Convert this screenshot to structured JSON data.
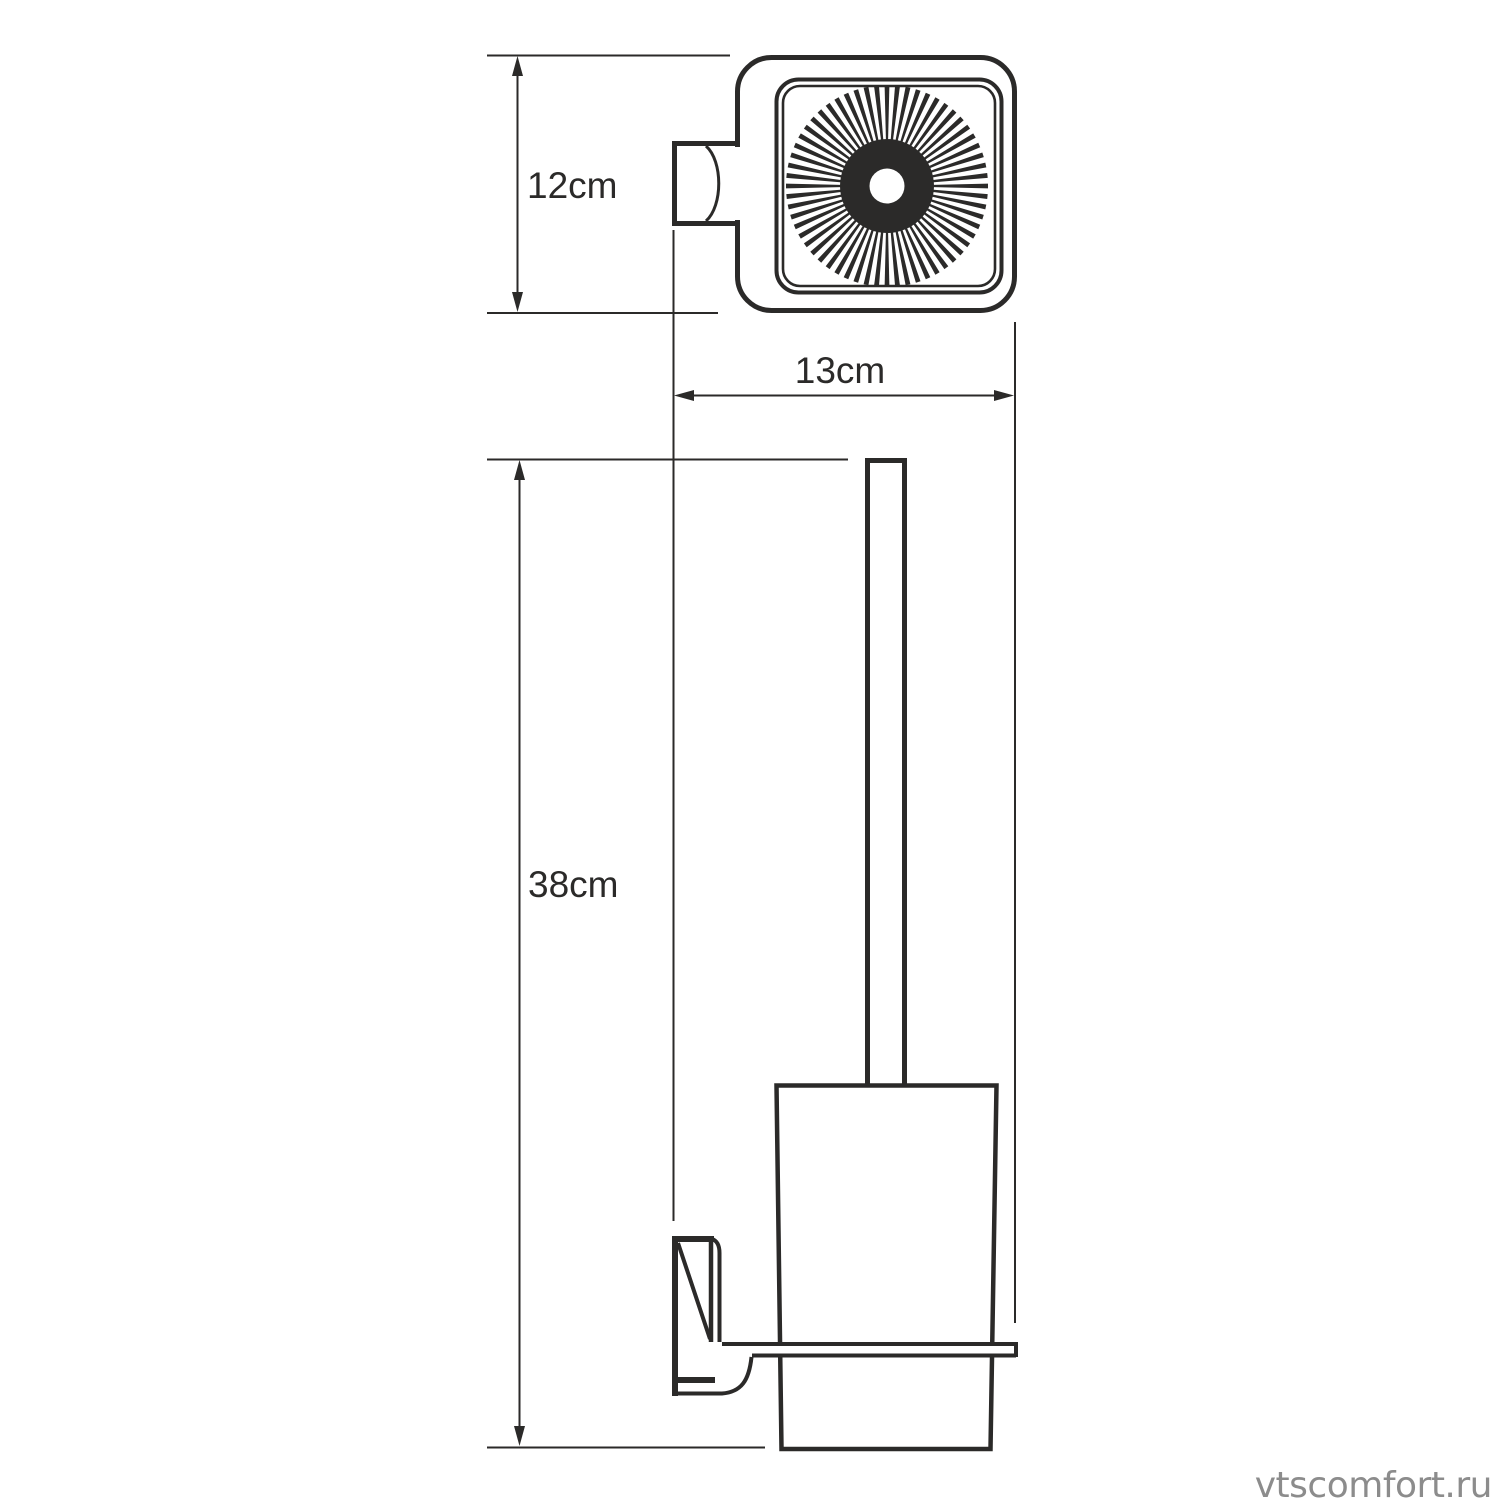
{
  "drawing": {
    "type": "technical-dimension-drawing",
    "views": {
      "top_view": "wall-mounted holder seen from above with brush bristles",
      "front_view": "wall-mounted toilet brush holder with handle and cup"
    },
    "dimensions": {
      "top_view_height": "12cm",
      "depth": "13cm",
      "front_height": "38cm"
    },
    "watermark": "vtscomfort.ru",
    "colors": {
      "line": "#2b2a29",
      "watermark": "#8c8c8c",
      "background": "#ffffff"
    }
  }
}
